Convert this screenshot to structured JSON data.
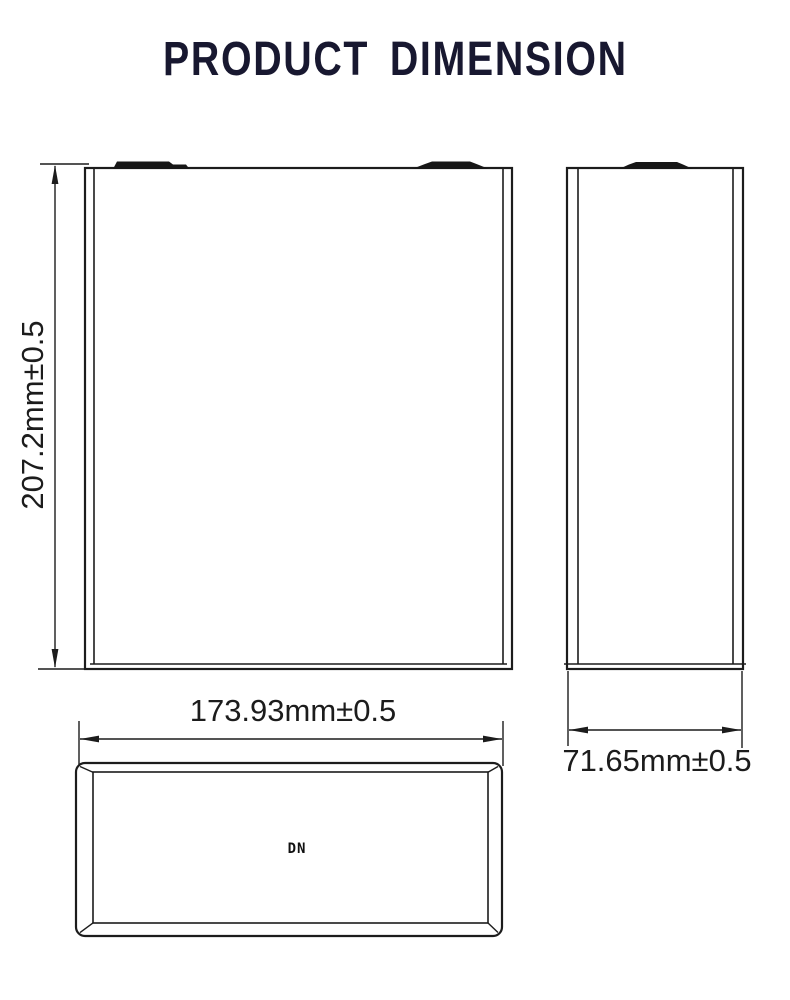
{
  "title": {
    "text": "PRODUCT DIMENSION"
  },
  "dimensions": {
    "height": {
      "label": "207.2mm±0.5"
    },
    "width": {
      "label": "173.93mm±0.5"
    },
    "depth": {
      "label": "71.65mm±0.5"
    }
  },
  "top_view": {
    "mark_label": "DN"
  },
  "colors": {
    "title": "#181830",
    "line": "#1c1c1c",
    "terminal_fill": "#161616",
    "background": "#ffffff"
  }
}
